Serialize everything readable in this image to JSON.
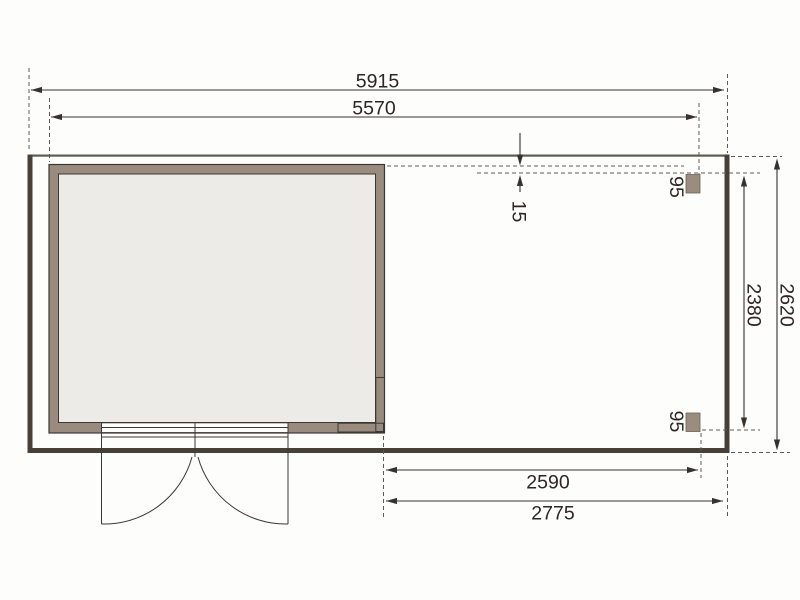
{
  "drawing": {
    "kind": "floor-plan",
    "dims": {
      "overall_width": "5915",
      "inner_width": "5570",
      "wall_offset": "15",
      "overall_depth": "2620",
      "inner_depth": "2380",
      "canopy_inner_width": "2590",
      "canopy_outer_width": "2775",
      "post_top": "95",
      "post_bottom": "95"
    },
    "colors": {
      "background": "#fdfdfc",
      "wall_fill": "#998b7e",
      "floor_fill": "#edebe7",
      "wall_outline": "#3c3733",
      "frame_bar": "#474039",
      "frame_top_line": "#5f5951",
      "dimension_line": "#36322e",
      "dashed_line": "#5d5a56",
      "label_text": "#2b2622",
      "post_fill": "#9a8c7f"
    }
  }
}
